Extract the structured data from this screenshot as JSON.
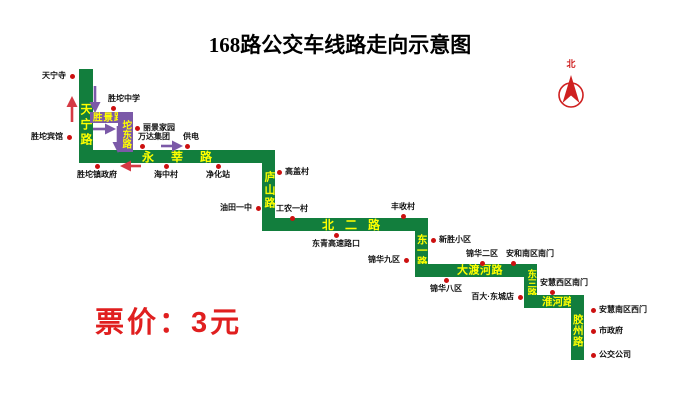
{
  "title": "168路公交车线路走向示意图",
  "fare_label": "票价：3元",
  "compass": {
    "north_label": "北"
  },
  "roads": {
    "tianning": "天宁路",
    "shengjing": "胜景路",
    "tuodong": "坨东路",
    "yongxin": "永莘路",
    "lushan": "庐山路",
    "beier": "北二路",
    "dongyi": "东一路",
    "daduhe": "大渡河路",
    "dongsan": "东三路",
    "huaihe": "淮河路",
    "jiaozhou": "胶州路"
  },
  "stops": [
    {
      "name": "天宁寺"
    },
    {
      "name": "胜坨宾馆"
    },
    {
      "name": "胜坨中学"
    },
    {
      "name": "丽景家园"
    },
    {
      "name": "万达集团"
    },
    {
      "name": "供电"
    },
    {
      "name": "胜坨镇政府"
    },
    {
      "name": "海中村"
    },
    {
      "name": "净化站"
    },
    {
      "name": "高盖村"
    },
    {
      "name": "油田一中"
    },
    {
      "name": "工农一村"
    },
    {
      "name": "东青高速路口"
    },
    {
      "name": "丰收村"
    },
    {
      "name": "新胜小区"
    },
    {
      "name": "锦华九区"
    },
    {
      "name": "锦华二区"
    },
    {
      "name": "安和南区南门"
    },
    {
      "name": "锦华八区"
    },
    {
      "name": "百大·东城店"
    },
    {
      "name": "安慧西区南门"
    },
    {
      "name": "安慧南区西门"
    },
    {
      "name": "市政府"
    },
    {
      "name": "公交公司"
    }
  ],
  "colors": {
    "route_green": "#127e3d",
    "oneway_purple": "#7b59a8",
    "road_label_yellow": "#ffff00",
    "stop_dot_red": "#cc1010",
    "fare_red": "#e01f1f",
    "arrow_red": "#d53a44",
    "compass_red": "#cf2020"
  }
}
